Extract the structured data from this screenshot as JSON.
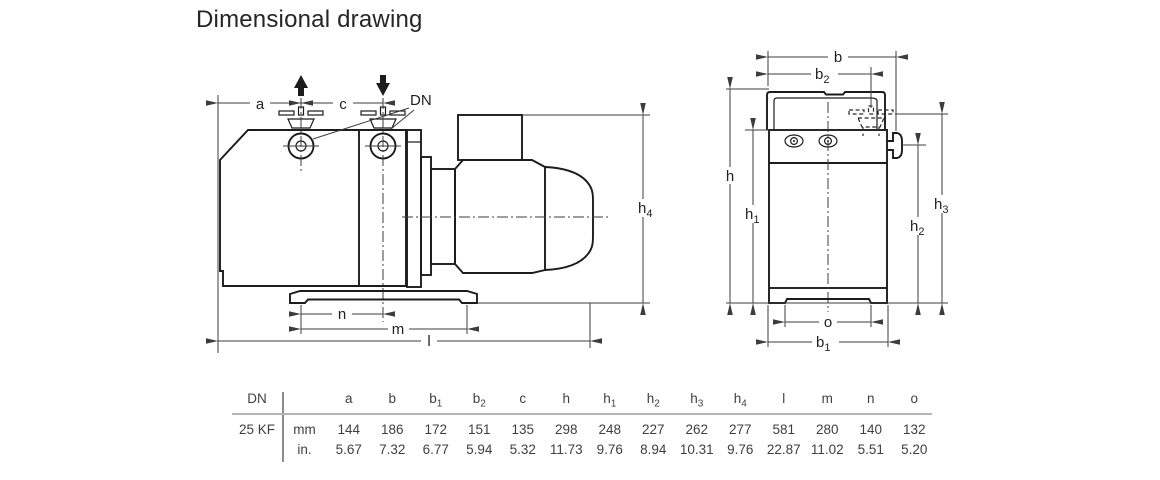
{
  "title": "Dimensional drawing",
  "drawing": {
    "side": {
      "a": {
        "base": "a",
        "sub": ""
      },
      "c": {
        "base": "c",
        "sub": ""
      },
      "dn": "DN",
      "h4": {
        "base": "h",
        "sub": "4"
      },
      "n": {
        "base": "n",
        "sub": ""
      },
      "m": {
        "base": "m",
        "sub": ""
      },
      "l": {
        "base": "l",
        "sub": ""
      }
    },
    "front": {
      "b": {
        "base": "b",
        "sub": ""
      },
      "b2": {
        "base": "b",
        "sub": "2"
      },
      "h": {
        "base": "h",
        "sub": ""
      },
      "h1": {
        "base": "h",
        "sub": "1"
      },
      "h2": {
        "base": "h",
        "sub": "2"
      },
      "h3": {
        "base": "h",
        "sub": "3"
      },
      "o": {
        "base": "o",
        "sub": ""
      },
      "b1": {
        "base": "b",
        "sub": "1"
      }
    }
  },
  "table": {
    "dn_header": "DN",
    "row_label": "25 KF",
    "unit_rows": [
      "mm",
      "in."
    ],
    "columns": [
      {
        "base": "a",
        "sub": ""
      },
      {
        "base": "b",
        "sub": ""
      },
      {
        "base": "b",
        "sub": "1"
      },
      {
        "base": "b",
        "sub": "2"
      },
      {
        "base": "c",
        "sub": ""
      },
      {
        "base": "h",
        "sub": ""
      },
      {
        "base": "h",
        "sub": "1"
      },
      {
        "base": "h",
        "sub": "2"
      },
      {
        "base": "h",
        "sub": "3"
      },
      {
        "base": "h",
        "sub": "4"
      },
      {
        "base": "l",
        "sub": ""
      },
      {
        "base": "m",
        "sub": ""
      },
      {
        "base": "n",
        "sub": ""
      },
      {
        "base": "o",
        "sub": ""
      }
    ],
    "mm": [
      "144",
      "186",
      "172",
      "151",
      "135",
      "298",
      "248",
      "227",
      "262",
      "277",
      "581",
      "280",
      "140",
      "132"
    ],
    "in": [
      "5.67",
      "7.32",
      "6.77",
      "5.94",
      "5.32",
      "11.73",
      "9.76",
      "8.94",
      "10.31",
      "9.76",
      "22.87",
      "11.02",
      "5.51",
      "5.20"
    ]
  }
}
